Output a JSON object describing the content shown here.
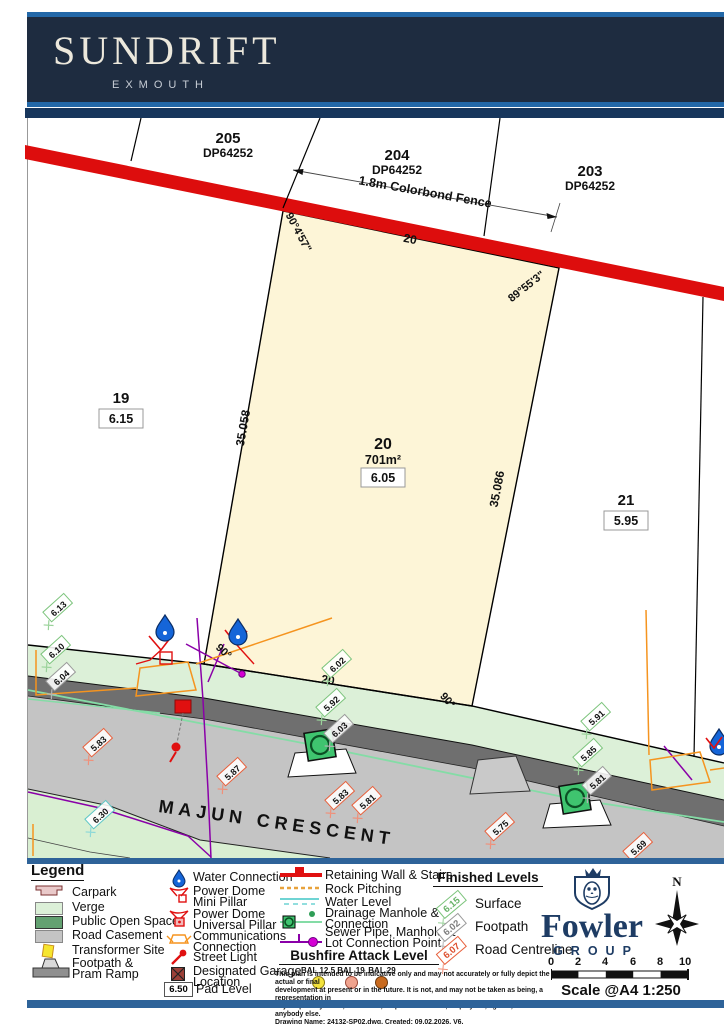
{
  "header": {
    "title": "SUNDRIFT",
    "subtitle": "EXMOUTH"
  },
  "map": {
    "street_name": "MAJUN CRESCENT",
    "fence_label": "1.8m Colorbond Fence",
    "lot205": {
      "num": "205",
      "plan": "DP64252"
    },
    "lot204": {
      "num": "204",
      "plan": "DP64252"
    },
    "lot203": {
      "num": "203",
      "plan": "DP64252"
    },
    "lot19": {
      "num": "19",
      "pad": "6.15"
    },
    "lot20": {
      "num": "20",
      "area": "701m²",
      "pad": "6.05"
    },
    "lot21": {
      "num": "21",
      "pad": "5.95"
    },
    "dim_top": "20",
    "dim_bottom": "20",
    "dim_left": "35.058",
    "dim_right": "35.086",
    "angle_top_left": "90°4'57\"",
    "angle_top_right": "89°55'3\"",
    "angle_bottom_left": "90°",
    "angle_bottom_right": "90°",
    "levels": [
      {
        "v": "6.13",
        "type": "surface"
      },
      {
        "v": "6.10",
        "type": "surface"
      },
      {
        "v": "6.04",
        "type": "footpath"
      },
      {
        "v": "6.02",
        "type": "surface"
      },
      {
        "v": "5.92",
        "type": "surface"
      },
      {
        "v": "6.03",
        "type": "footpath"
      },
      {
        "v": "5.91",
        "type": "surface"
      },
      {
        "v": "5.85",
        "type": "surface"
      },
      {
        "v": "5.81",
        "type": "footpath"
      },
      {
        "v": "5.83",
        "type": "road"
      },
      {
        "v": "5.87",
        "type": "road"
      },
      {
        "v": "5.83",
        "type": "road"
      },
      {
        "v": "5.81",
        "type": "road"
      },
      {
        "v": "5.75",
        "type": "road"
      },
      {
        "v": "5.69",
        "type": "road"
      },
      {
        "v": "6.30",
        "type": "water"
      }
    ]
  },
  "legend": {
    "title": "Legend",
    "areas": [
      {
        "label": "Carpark"
      },
      {
        "label": "Verge"
      },
      {
        "label": "Public Open Space"
      },
      {
        "label": "Road Casement"
      },
      {
        "label": "Transformer Site"
      },
      {
        "label": "Footpath & Pram Ramp"
      }
    ],
    "utilities": [
      {
        "label": "Water Connection"
      },
      {
        "label": "Power Dome Mini Pillar"
      },
      {
        "label": "Power Dome Universal Pillar"
      },
      {
        "label": "Communications Connection"
      },
      {
        "label": "Street Light"
      },
      {
        "label": "Designated Garage Location"
      },
      {
        "label": "Pad Level",
        "value": "6.50"
      }
    ],
    "lines": [
      {
        "label": "Retaining Wall & Stairs"
      },
      {
        "label": "Rock Pitching"
      },
      {
        "label": "Water Level"
      },
      {
        "label": "Drainage Manhole & Connection"
      },
      {
        "label": "Sewer Pipe, Manhole & Lot Connection Point"
      }
    ],
    "bushfire": {
      "title": "Bushfire Attack Level",
      "items": [
        {
          "label": "BAL 12.5"
        },
        {
          "label": "BAL 19"
        },
        {
          "label": "BAL 29"
        }
      ]
    },
    "finished_levels": {
      "title": "Finished Levels",
      "rows": [
        {
          "value": "6.15",
          "label": "Surface"
        },
        {
          "value": "6.02",
          "label": "Footpath"
        },
        {
          "value": "6.07",
          "label": "Road Centreline"
        }
      ]
    },
    "disclaimer": [
      "This plan is intended to be indicative only and may not accurately or fully depict the actual or final",
      "development at present or in the future. It is not, and may not be taken as being, a representation in",
      "any respect by seller, landowner, respective officers, employees, agents, advisers or anybody else.",
      "Drawing Name: 24132-SP02.dwg, Created: 09.02.2026, V6."
    ]
  },
  "footer": {
    "brand_name": "Fowler",
    "brand_sub": "GROUP",
    "compass_n": "N",
    "scale_label": "Scale @A4 1:250",
    "scale_ticks": [
      "0",
      "2",
      "4",
      "6",
      "8",
      "10"
    ]
  },
  "colors": {
    "navy": "#1e2c40",
    "accent_blue": "#2368a8",
    "steel_bar": "#2e6399",
    "retaining_wall_red": "#dd0d0d",
    "lot_fill": "#fdf5d7",
    "verge_green": "#dcf0d8",
    "road_dark": "#6f6f6f",
    "road_casement": "#c4c4c4",
    "drainage_green": "#84dca6",
    "sewer_purple": "#8a00a8",
    "comms_orange": "#f5941f",
    "water_blue": "#1565d8",
    "surface_level": "#7cc47c",
    "footpath_level": "#9a9a9a",
    "road_level": "#e8603c"
  }
}
